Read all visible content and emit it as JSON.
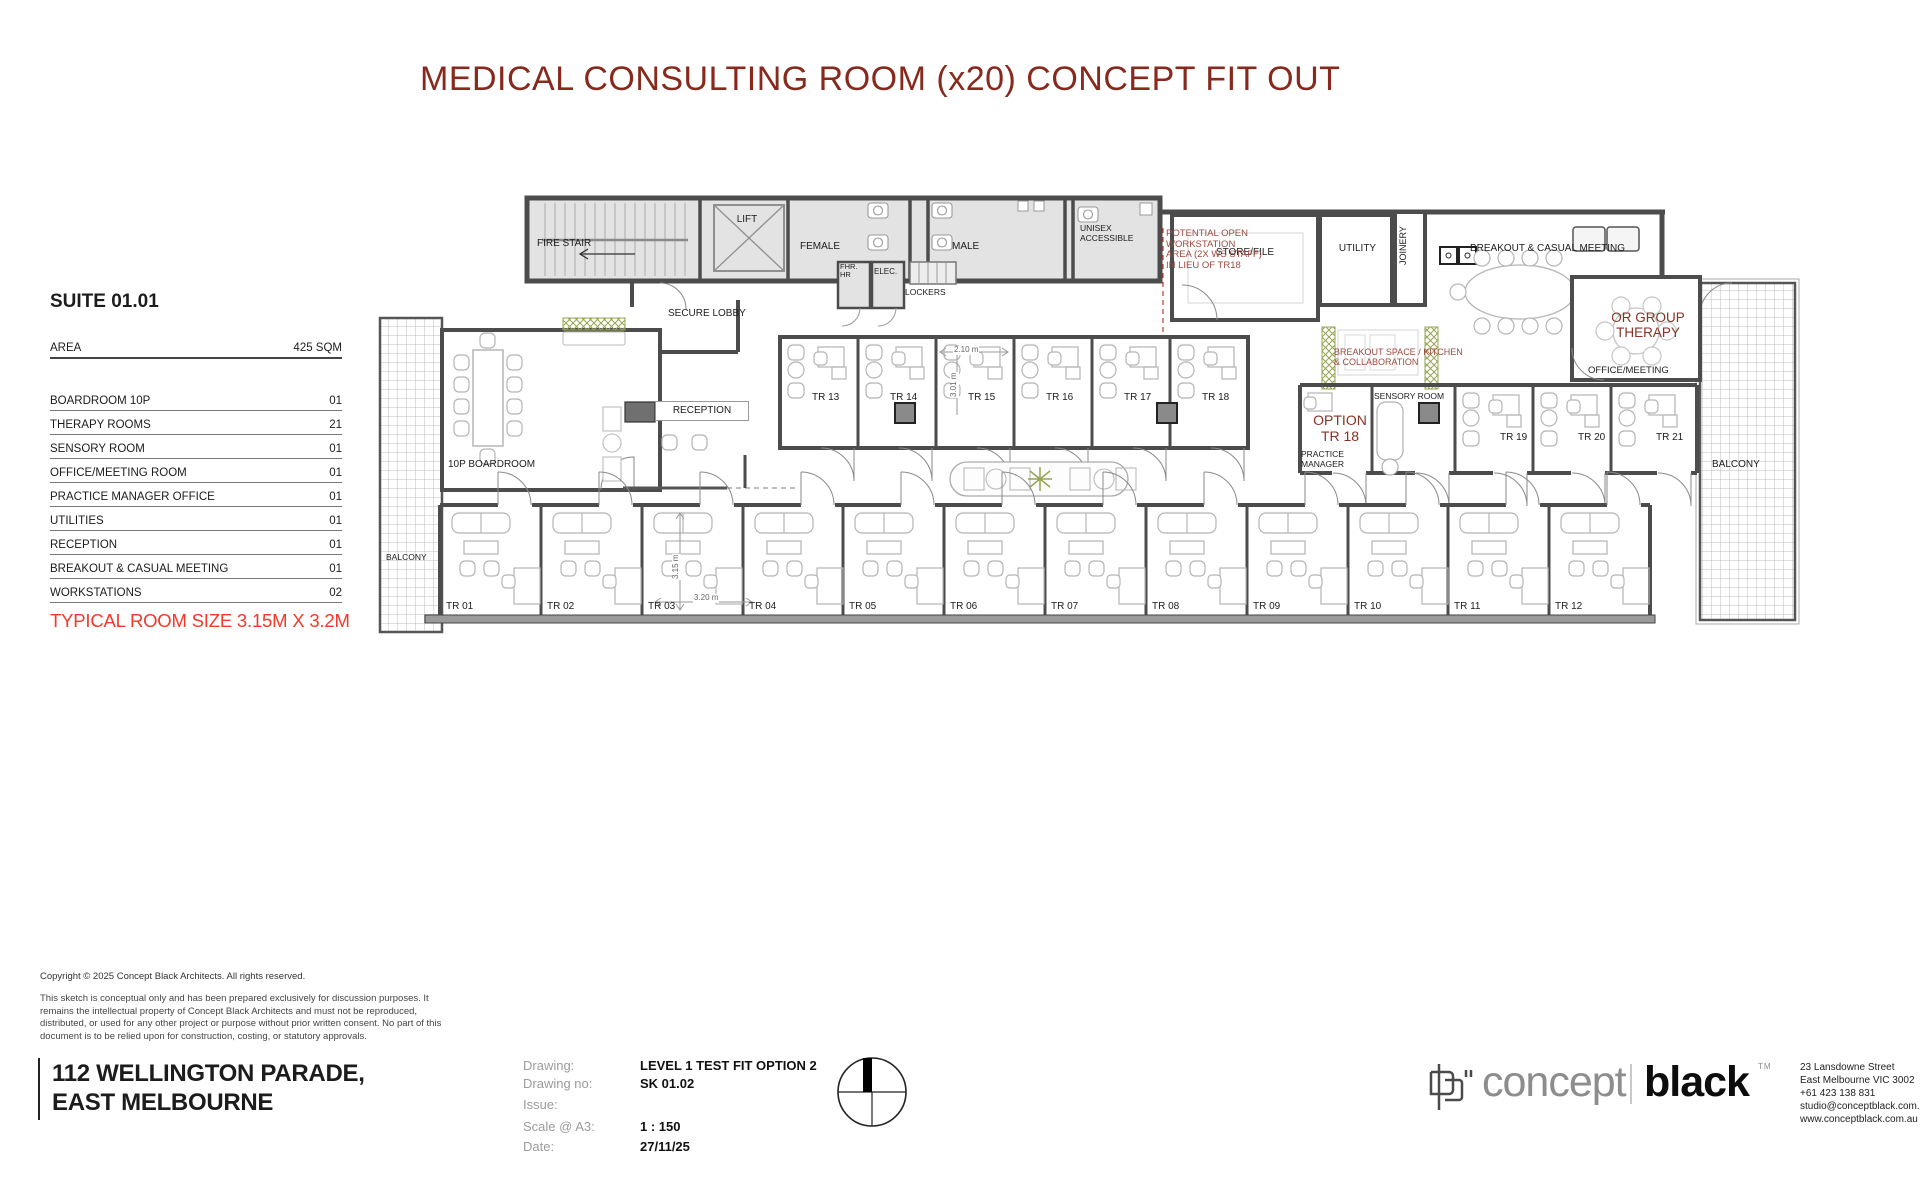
{
  "title": "MEDICAL CONSULTING ROOM (x20) CONCEPT FIT OUT",
  "suite": {
    "heading": "SUITE 01.01",
    "area_label": "AREA",
    "area_value": "425 SQM",
    "rows": [
      {
        "label": "BOARDROOM 10P",
        "value": "01"
      },
      {
        "label": "THERAPY ROOMS",
        "value": "21"
      },
      {
        "label": "SENSORY ROOM",
        "value": "01"
      },
      {
        "label": "OFFICE/MEETING ROOM",
        "value": "01"
      },
      {
        "label": "PRACTICE MANAGER OFFICE",
        "value": "01"
      },
      {
        "label": "UTILITIES",
        "value": "01"
      },
      {
        "label": "RECEPTION",
        "value": "01"
      },
      {
        "label": "BREAKOUT & CASUAL MEETING",
        "value": "01"
      },
      {
        "label": "WORKSTATIONS",
        "value": "02"
      }
    ],
    "typical_room_note": "TYPICAL ROOM SIZE 3.15M X 3.2M"
  },
  "plan": {
    "service": {
      "fire_stair": "FIRE STAIR",
      "lift": "LIFT",
      "female": "FEMALE",
      "fhr_hr": "FHR.\nHR",
      "elec": "ELEC.",
      "lockers": "LOCKERS",
      "male": "MALE",
      "unisex": "UNISEX\nACCESSIBLE",
      "store_file": "STORE/FILE",
      "utility": "UTILITY",
      "joinery": "JOINERY",
      "breakout": "BREAKOUT & CASUAL MEETING"
    },
    "areas": {
      "secure_lobby": "SECURE LOBBY",
      "reception": "RECEPTION",
      "boardroom": "10P BOARDROOM",
      "balcony_left": "BALCONY",
      "balcony_right": "BALCONY",
      "or_group_therapy": "OR GROUP\nTHERAPY",
      "office_meeting": "OFFICE/MEETING",
      "option_tr18": "OPTION\nTR 18",
      "practice_manager": "PRACTICE\nMANAGER",
      "sensory_room": "SENSORY ROOM"
    },
    "notes": {
      "workstation": "POTENTIAL OPEN\nWORKSTATION\nAREA (2X WS STAFF)\nIN LIEU OF TR18",
      "kitchen": "BREAKOUT SPACE / KITCHEN\n& COLLABORATION"
    },
    "dims": {
      "d210": "2.10 m",
      "d301": "3.01 m",
      "d315": "3.15 m",
      "d320": "3.20 m"
    },
    "tr": {
      "bottom": [
        "TR 01",
        "TR 02",
        "TR 03",
        "TR 04",
        "TR 05",
        "TR 06",
        "TR 07",
        "TR 08",
        "TR 09",
        "TR 10",
        "TR 11",
        "TR 12"
      ],
      "mid": [
        "TR 13",
        "TR 14",
        "TR 15",
        "TR 16",
        "TR 17",
        "TR 18"
      ],
      "right": [
        "TR 19",
        "TR 20",
        "TR 21"
      ]
    }
  },
  "footer": {
    "copyright": "Copyright © 2025 Concept Black Architects. All rights reserved.",
    "disclaimer": "This sketch is conceptual only and has been prepared exclusively for discussion purposes. It remains the intellectual property of Concept Black Architects and must not be reproduced, distributed, or used for any other project or purpose without prior written consent. No part of this document is to be relied upon for construction, costing, or statutory approvals.",
    "address_line1": "112 WELLINGTON PARADE,",
    "address_line2": "EAST MELBOURNE",
    "meta": {
      "drawing_label": "Drawing:",
      "drawing_value": "LEVEL 1 TEST FIT OPTION 2",
      "drawing_no_label": "Drawing no:",
      "drawing_no_value": "SK 01.02",
      "issue_label": "Issue:",
      "issue_value": "",
      "scale_label": "Scale @ A3:",
      "scale_value": "1 : 150",
      "date_label": "Date:",
      "date_value": "27/11/25"
    },
    "logo": {
      "concept": "concept",
      "black": "black",
      "tm": "TM"
    },
    "studio_address": [
      "23 Lansdowne Street",
      "East Melbourne VIC 3002",
      "+61 423 138 831",
      "studio@conceptblack.com.au",
      "www.conceptblack.com.au"
    ]
  },
  "colors": {
    "title_red": "#87291c",
    "note_red": "#9c4a40",
    "option_red": "#883325",
    "accent_red": "#f4392b",
    "wall_gray": "#4c4c4c"
  }
}
